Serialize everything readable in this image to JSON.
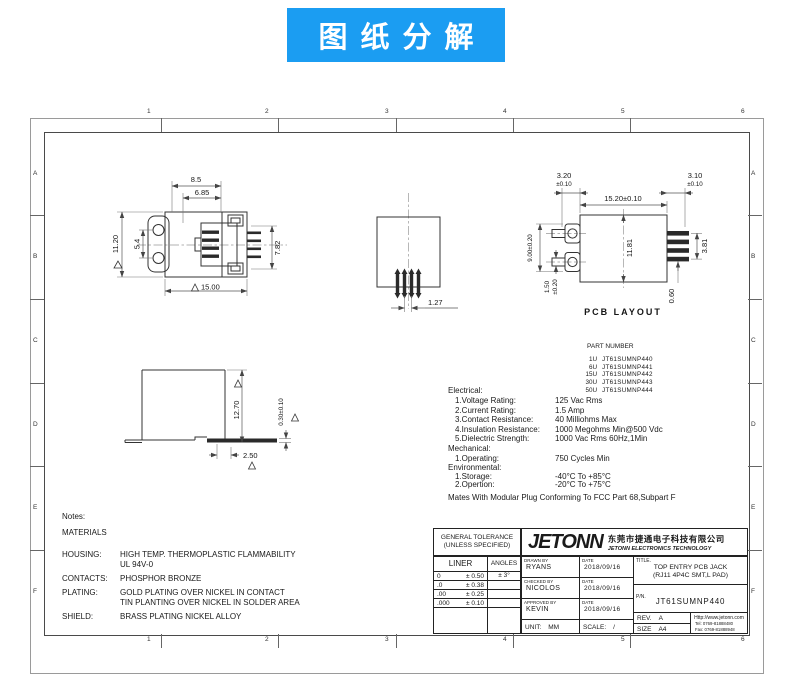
{
  "banner": {
    "text": "图纸分解",
    "bg": "#1b9df2",
    "fg": "#ffffff"
  },
  "frame": {
    "cols": [
      "1",
      "2",
      "3",
      "4",
      "5",
      "6"
    ],
    "rows": [
      "A",
      "B",
      "C",
      "D",
      "E",
      "F"
    ]
  },
  "front_view": {
    "dim_top": "8.5",
    "dim_top2": "6.85",
    "dim_height": "11.20",
    "dim_holes": "5.4",
    "dim_right": "7.82",
    "dim_width": "15.00"
  },
  "center_view": {
    "dim_pitch": "1.27"
  },
  "pcb_view": {
    "label": "PCB LAYOUT",
    "dim_left_pad": "3.20",
    "dim_left_pad_tol": "±0.10",
    "dim_body": "15.20±0.10",
    "dim_right_pad": "3.10",
    "dim_right_pad_tol": "±0.10",
    "dim_height": "9.00±0.20",
    "dim_pad_h": "1.50",
    "dim_pad_h_tol": "±0.20",
    "dim_inner": "11.81",
    "dim_pin_span": "3.81",
    "dim_pad_t": "0.60"
  },
  "side_view": {
    "dim_height": "12.70",
    "dim_standoff": "0.30±0.10",
    "dim_tail": "2.50"
  },
  "part_number": {
    "heading": "PART NUMBER",
    "items": [
      {
        "qty": "1U",
        "pn": "JT61SUMNP440"
      },
      {
        "qty": "6U",
        "pn": "JT61SUMNP441"
      },
      {
        "qty": "15U",
        "pn": "JT61SUMNP442"
      },
      {
        "qty": "30U",
        "pn": "JT61SUMNP443"
      },
      {
        "qty": "50U",
        "pn": "JT61SUMNP444"
      }
    ]
  },
  "specs": {
    "electrical_heading": "Electrical:",
    "electrical": [
      {
        "label": "1.Voltage Rating:",
        "value": "125 Vac Rms"
      },
      {
        "label": "2.Current Rating:",
        "value": "1.5 Amp"
      },
      {
        "label": "3.Contact Resistance:",
        "value": "40 Milliohms Max"
      },
      {
        "label": "4.Insulation Resistance:",
        "value": "1000 Megohms Min@500 Vdc"
      },
      {
        "label": "5.Dielectric Strength:",
        "value": "1000 Vac Rms 60Hz,1Min"
      }
    ],
    "mechanical_heading": "Mechanical:",
    "mechanical": [
      {
        "label": "1.Operating:",
        "value": "750 Cycles Min"
      }
    ],
    "environmental_heading": "Environmental:",
    "environmental": [
      {
        "label": "1.Storage:",
        "value": "-40°C To +85°C"
      },
      {
        "label": "2.Opertion:",
        "value": "-20°C To +75°C"
      }
    ],
    "mates_note": "Mates With Modular Plug Conforming To FCC Part 68,Subpart F"
  },
  "notes": {
    "heading": "Notes:",
    "materials_heading": "MATERIALS",
    "rows": [
      {
        "label": "HOUSING:",
        "line1": "HIGH TEMP. THERMOPLASTIC FLAMMABILITY",
        "line2": "UL 94V-0"
      },
      {
        "label": "CONTACTS:",
        "line1": "PHOSPHOR BRONZE",
        "line2": ""
      },
      {
        "label": "PLATING:",
        "line1": "GOLD PLATING OVER NICKEL IN CONTACT",
        "line2": "TIN PLANTING OVER NICKEL IN SOLDER AREA"
      },
      {
        "label": "SHIELD:",
        "line1": "BRASS PLATING NICKEL ALLOY",
        "line2": ""
      }
    ]
  },
  "title_block": {
    "general_tolerance_1": "GENERAL TOLERANCE",
    "general_tolerance_2": "(UNLESS SPECIFIED)",
    "liner_label": "LINER",
    "angles_label": "ANGLES",
    "tol_rows": [
      {
        "nom": "0",
        "tol": "± 0.50"
      },
      {
        "nom": ".0",
        "tol": "± 0.38"
      },
      {
        "nom": ".00",
        "tol": "± 0.25"
      },
      {
        "nom": ".000",
        "tol": "± 0.10"
      }
    ],
    "angles_tol": "± 3°",
    "logo_text": "JETONN",
    "company_cn": "东莞市捷通电子科技有限公司",
    "company_en": "JETONN ELECTRONICS TECHNOLOGY",
    "drawn_label": "DRAWN BY",
    "drawn_name": "RYANS",
    "date_label": "DATE",
    "drawn_date": "2018/09/16",
    "checked_label": "CHECKED BY",
    "checked_name": "NICOLOS",
    "checked_date": "2018/09/16",
    "approved_label": "APPROVED BY",
    "approved_name": "KEVIN",
    "approved_date": "2018/09/16",
    "unit_label": "UNIT:",
    "unit_value": "MM",
    "scale_label": "SCALE:",
    "scale_value": "/",
    "title_label": "TITLE.",
    "title_line1": "TOP ENTRY PCB JACK",
    "title_line2": "(RJ11 4P4C SMT,L PAD)",
    "pn_label": "P/N.",
    "pn_value": "JT61SUMNP440",
    "rev_label": "REV.",
    "rev_value": "A",
    "size_label": "SIZE",
    "size_value": "A4",
    "website": "Http://www.jetonn.com",
    "tel": "Tel: 0769-81888480",
    "fax": "Fax: 0769-81888948"
  }
}
